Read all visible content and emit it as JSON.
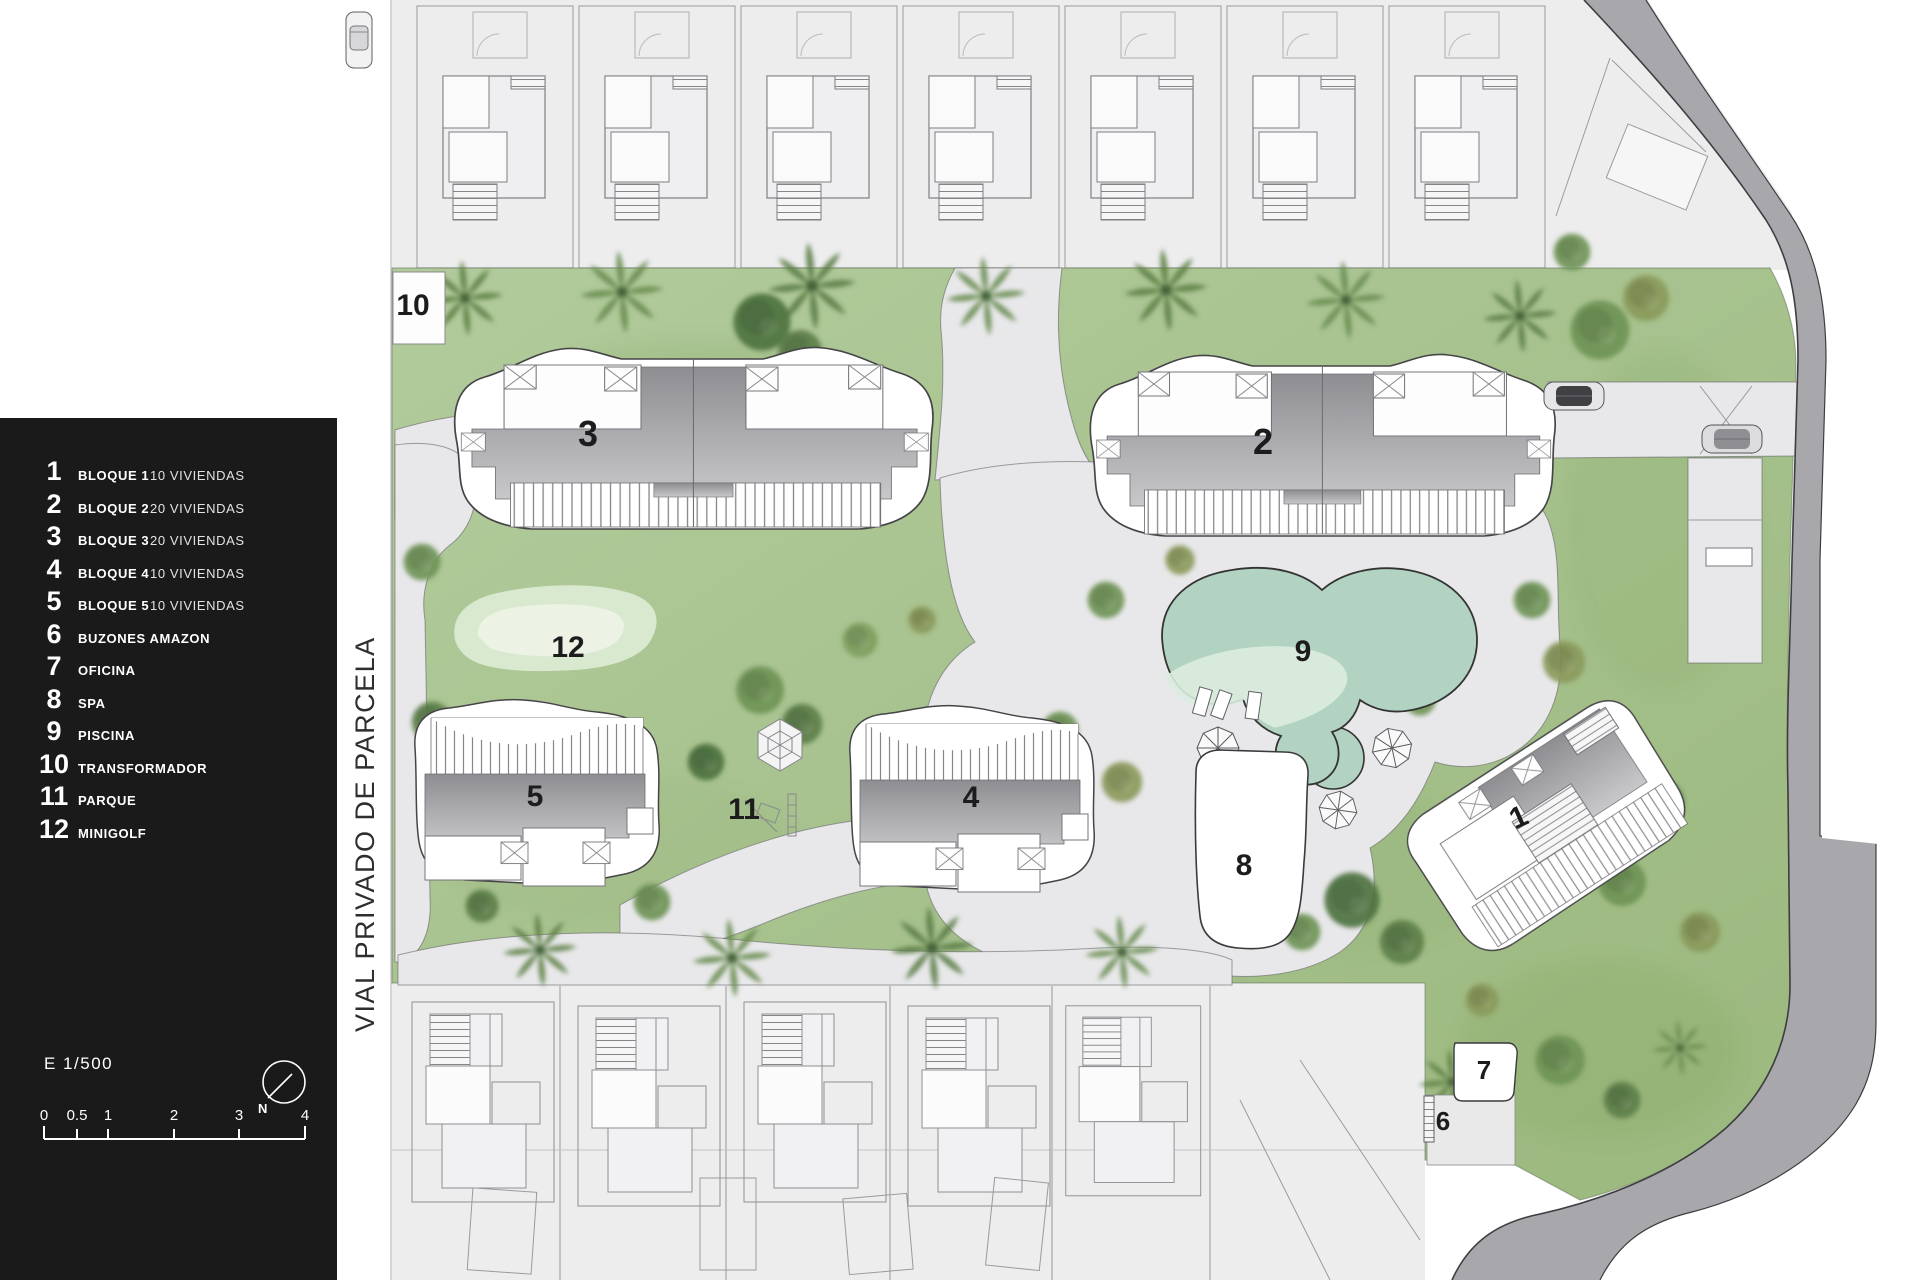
{
  "legend": {
    "items": [
      {
        "num": "1",
        "label": "BLOQUE 1",
        "detail": "10 VIVIENDAS"
      },
      {
        "num": "2",
        "label": "BLOQUE 2",
        "detail": "20 VIVIENDAS"
      },
      {
        "num": "3",
        "label": "BLOQUE 3",
        "detail": "20 VIVIENDAS"
      },
      {
        "num": "4",
        "label": "BLOQUE 4",
        "detail": "10 VIVIENDAS"
      },
      {
        "num": "5",
        "label": "BLOQUE 5",
        "detail": "10 VIVIENDAS"
      },
      {
        "num": "6",
        "label": "BUZONES AMAZON",
        "detail": ""
      },
      {
        "num": "7",
        "label": "OFICINA",
        "detail": ""
      },
      {
        "num": "8",
        "label": "SPA",
        "detail": ""
      },
      {
        "num": "9",
        "label": "PISCINA",
        "detail": ""
      },
      {
        "num": "10",
        "label": "TRANSFORMADOR",
        "detail": ""
      },
      {
        "num": "11",
        "label": "PARQUE",
        "detail": ""
      },
      {
        "num": "12",
        "label": "MINIGOLF",
        "detail": ""
      }
    ]
  },
  "scale": {
    "label": "E 1/500",
    "ticks": [
      "0",
      "0.5",
      "1",
      "2",
      "3",
      "4"
    ]
  },
  "north": {
    "label": "N"
  },
  "street": {
    "label": "VIAL PRIVADO DE PARCELA"
  },
  "plan": {
    "markers": [
      {
        "text": "1"
      },
      {
        "text": "2"
      },
      {
        "text": "3"
      },
      {
        "text": "4"
      },
      {
        "text": "5"
      },
      {
        "text": "6"
      },
      {
        "text": "7"
      },
      {
        "text": "8"
      },
      {
        "text": "9"
      },
      {
        "text": "10"
      },
      {
        "text": "11"
      },
      {
        "text": "12"
      }
    ]
  },
  "colors": {
    "panel": "#1a1a1a",
    "grass": "#a9c48f",
    "path": "#e8e8ea",
    "road": "#a8a8ac",
    "pool": "#b2d3c2",
    "building": "#9d9da1",
    "minigolf": "#d9e9cf"
  }
}
